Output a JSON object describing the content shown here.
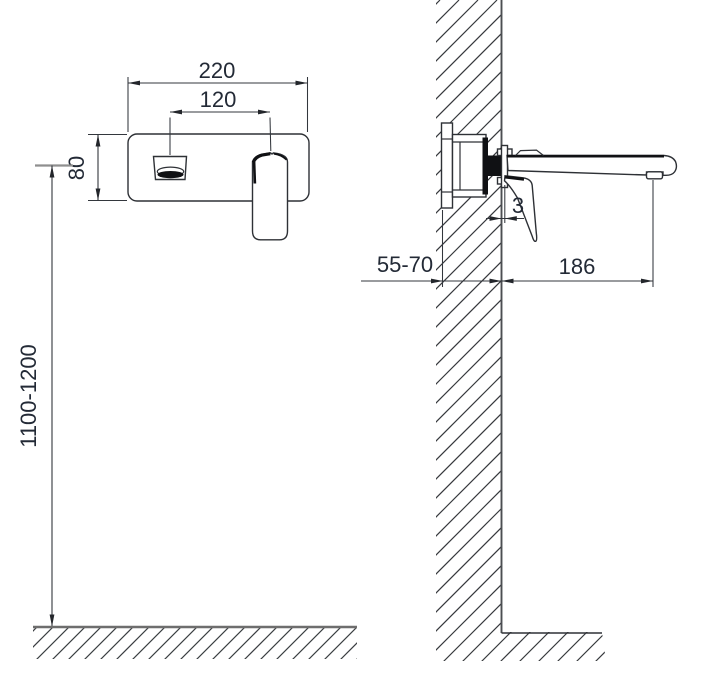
{
  "drawing": {
    "type": "installation-dimension-drawing",
    "subject": "wall-mounted-basin-mixer",
    "dimensions": {
      "plate_width": "220",
      "spout_to_handle": "120",
      "plate_height": "80",
      "mounting_height": "1100-1200",
      "wall_embed_depth": "55-70",
      "spout_reach": "186",
      "handle_wall_gap": "3"
    },
    "colors": {
      "line": "#2e3136",
      "text": "#232a36",
      "dark_fill": "#101114",
      "reference_line": "#8f8f8f",
      "floor_line": "#6e6e6e",
      "background": "#ffffff"
    }
  }
}
